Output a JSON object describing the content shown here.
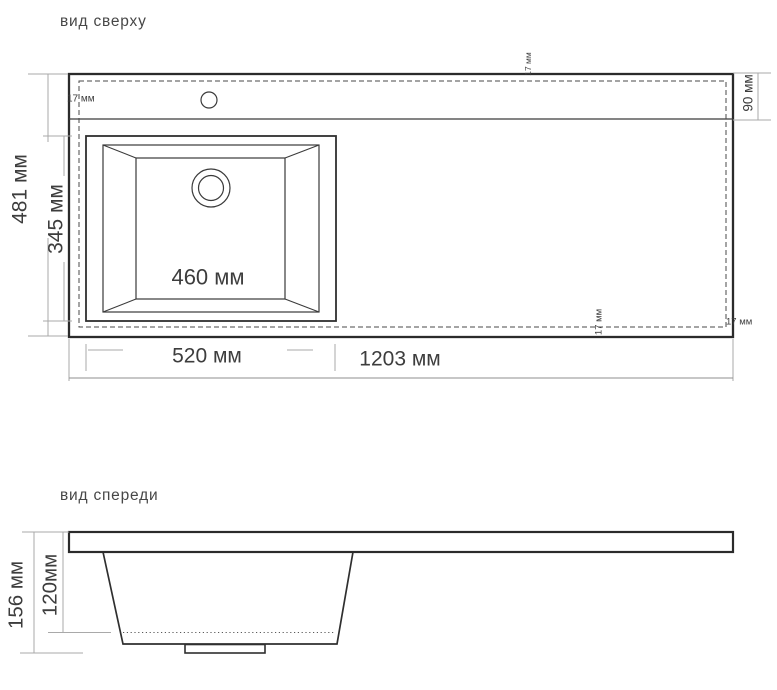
{
  "drawing": {
    "top_view": {
      "title": "вид сверху",
      "dims": {
        "overall_width": "1203 мм",
        "overall_depth": "481 мм",
        "bowl_outer_width": "520 мм",
        "bowl_depth": "345 мм",
        "bowl_inner_width": "460 мм",
        "rear_strip_depth": "90 мм",
        "edge_offset_left": "17 мм",
        "edge_offset_top": "17 мм",
        "edge_offset_bottom": "17 мм",
        "edge_offset_right": "17 мм"
      }
    },
    "front_view": {
      "title": "вид спереди",
      "dims": {
        "overall_height": "156 мм",
        "bowl_height": "120мм"
      }
    },
    "colors": {
      "outline_ink": "#2b2b2b",
      "dimension_line": "#a9a9a9",
      "dimension_text": "#3d3d3d",
      "background": "#ffffff"
    }
  }
}
